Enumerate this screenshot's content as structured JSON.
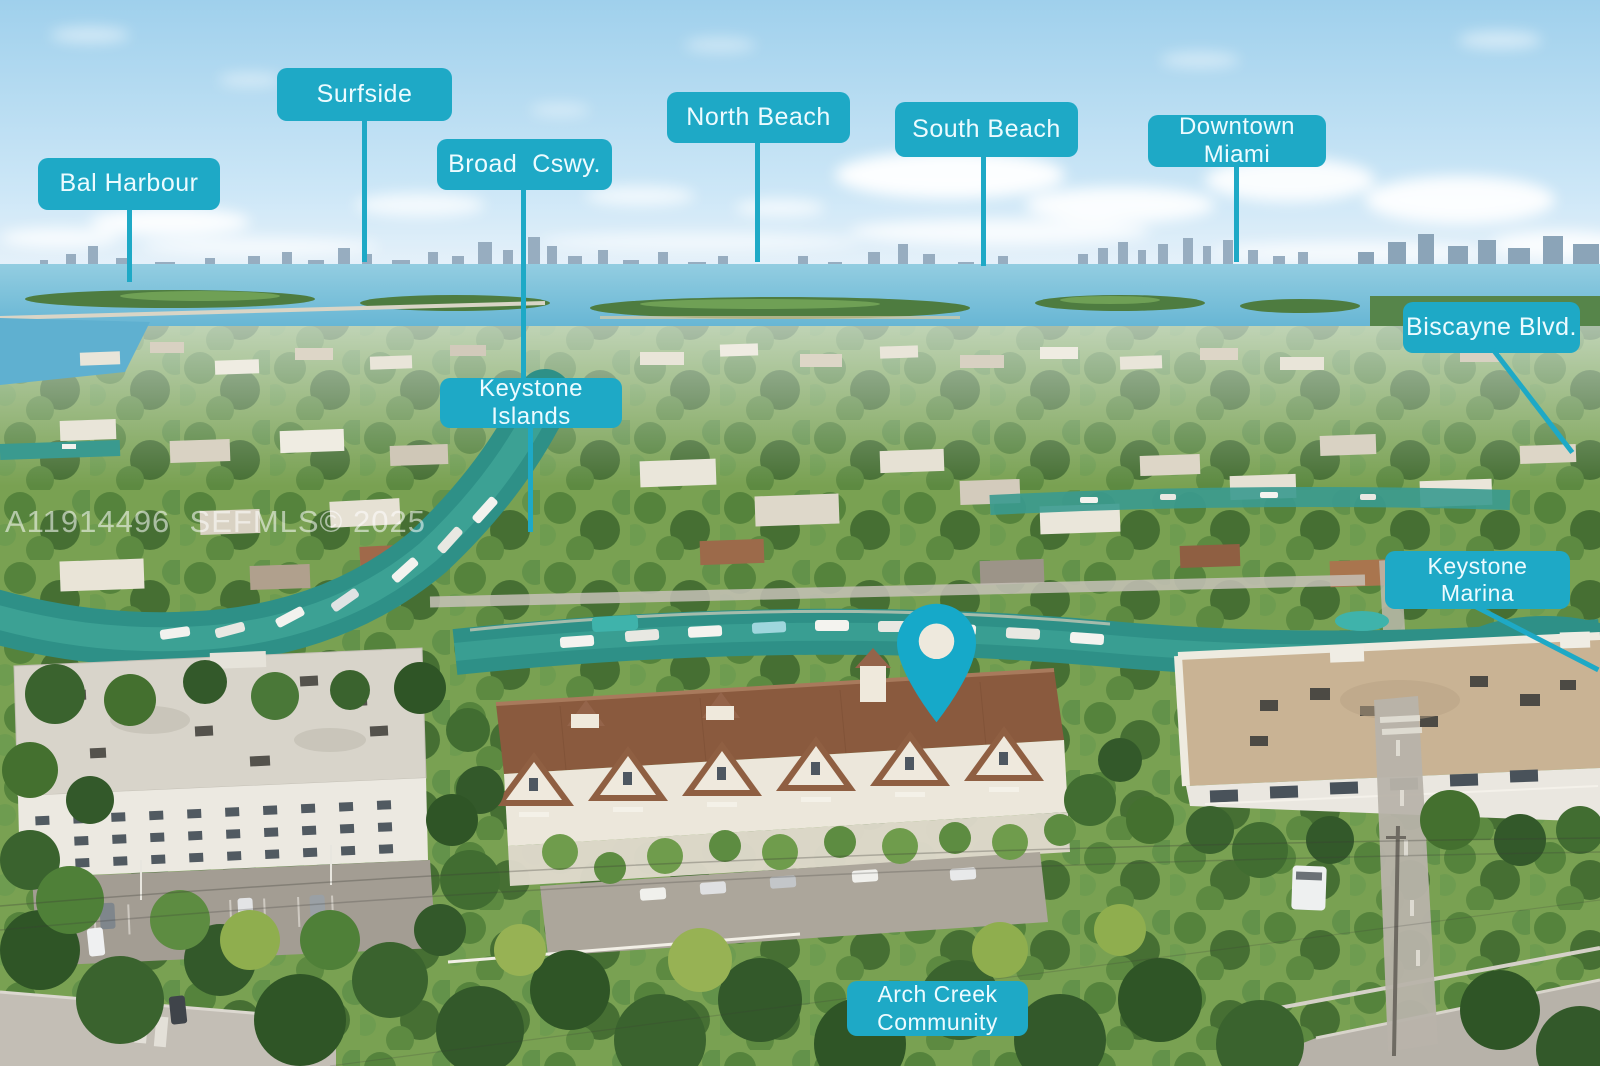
{
  "watermark": {
    "text": "A11914496  SEFMLS© 2025"
  },
  "callouts": [
    {
      "text": "Bal Harbour"
    },
    {
      "text": "Surfside"
    },
    {
      "text": "Broad  Cswy."
    },
    {
      "text": "North Beach"
    },
    {
      "text": "South Beach"
    },
    {
      "text": "Downtown Miami"
    },
    {
      "text": "Biscayne Blvd."
    },
    {
      "text": "Keystone Islands"
    },
    {
      "text": "Keystone Marina"
    },
    {
      "text": "Arch Creek Community"
    }
  ],
  "colors": {
    "callout_bg": "#1ea9c6",
    "callout_text": "#ecfbff",
    "pin": "#16a9c9"
  }
}
